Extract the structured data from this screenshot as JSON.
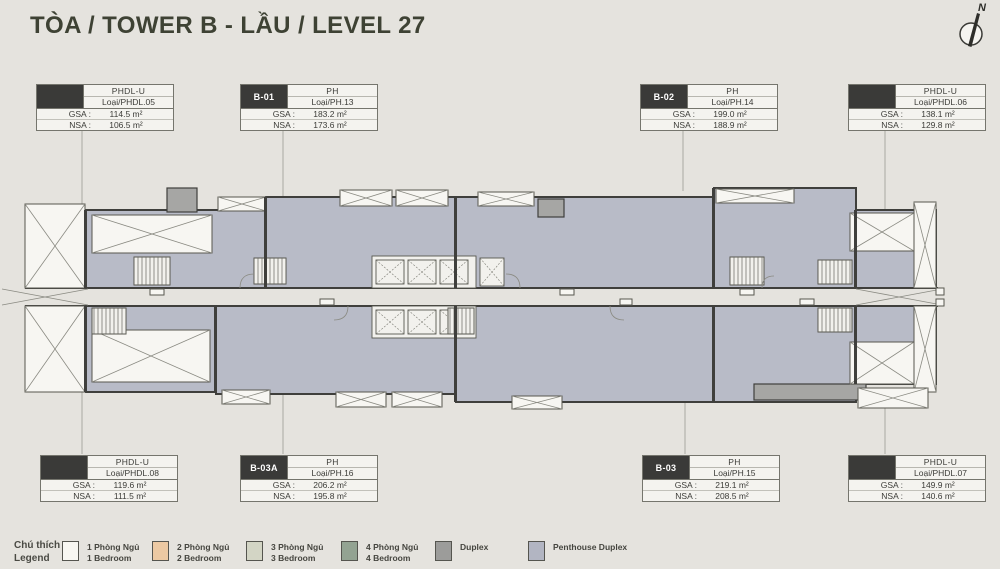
{
  "title": "TÒA / TOWER B - LẦU / LEVEL 27",
  "compass": {
    "north_label": "N"
  },
  "field_labels": {
    "gsa": "GSA :",
    "nsa": "NSA :"
  },
  "units": [
    {
      "code": "",
      "type": "PHDL-U",
      "layout": "Loại/PHDL.05",
      "gsa": "114.5 m²",
      "nsa": "106.5 m²"
    },
    {
      "code": "B-01",
      "type": "PH",
      "layout": "Loại/PH.13",
      "gsa": "183.2 m²",
      "nsa": "173.6 m²"
    },
    {
      "code": "B-02",
      "type": "PH",
      "layout": "Loại/PH.14",
      "gsa": "199.0 m²",
      "nsa": "188.9 m²"
    },
    {
      "code": "",
      "type": "PHDL-U",
      "layout": "Loại/PHDL.06",
      "gsa": "138.1 m²",
      "nsa": "129.8 m²"
    },
    {
      "code": "",
      "type": "PHDL-U",
      "layout": "Loại/PHDL.08",
      "gsa": "119.6 m²",
      "nsa": "111.5 m²"
    },
    {
      "code": "B-03A",
      "type": "PH",
      "layout": "Loại/PH.16",
      "gsa": "206.2 m²",
      "nsa": "195.8 m²"
    },
    {
      "code": "B-03",
      "type": "PH",
      "layout": "Loại/PH.15",
      "gsa": "219.1 m²",
      "nsa": "208.5 m²"
    },
    {
      "code": "",
      "type": "PHDL-U",
      "layout": "Loại/PHDL.07",
      "gsa": "149.9 m²",
      "nsa": "140.6 m²"
    }
  ],
  "legend": {
    "title_vi": "Chú thích",
    "title_en": "Legend",
    "items": [
      {
        "vi": "1 Phòng Ngủ",
        "en": "1 Bedroom",
        "color": "#f8f7f2"
      },
      {
        "vi": "2 Phòng Ngủ",
        "en": "2 Bedroom",
        "color": "#ecc9a3"
      },
      {
        "vi": "3 Phòng Ngủ",
        "en": "3 Bedroom",
        "color": "#d3d5c5"
      },
      {
        "vi": "4 Phòng Ngủ",
        "en": "4 Bedroom",
        "color": "#93a392"
      },
      {
        "vi": "Duplex",
        "en": "",
        "color": "#9c9c9a"
      },
      {
        "vi": "Penthouse Duplex",
        "en": "",
        "color": "#b2b5c2"
      }
    ]
  },
  "colors": {
    "background": "#e5e3de",
    "unit_fill": "#b8bbc7",
    "wall": "#3f3f3c"
  }
}
